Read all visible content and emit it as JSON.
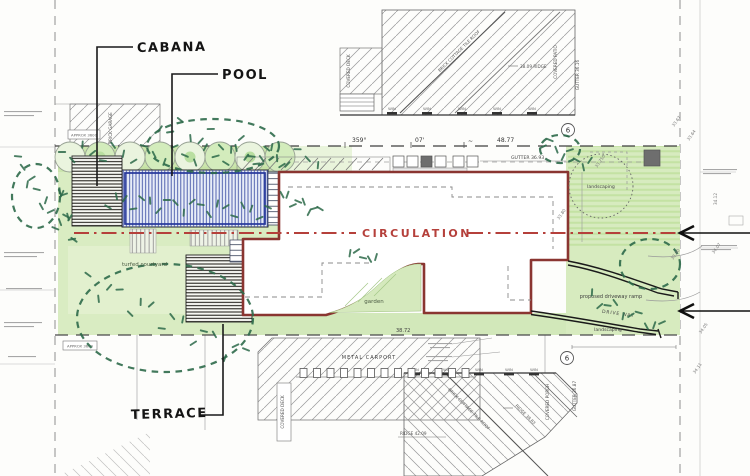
{
  "labels": {
    "cabana": "CABANA",
    "pool": "POOL",
    "terrace": "TERRACE",
    "circulation": "CIRCULATION"
  },
  "site_annotations": {
    "turfed_courtyard": "turfed courtyard",
    "garden": "garden",
    "landscaping_circle": "landscaping",
    "landscaping_strip": "landscaping",
    "proposed_driveway_ramp": "proposed driveway ramp",
    "driveway": "DRIVE WAY",
    "metal_carport": "METAL  CARPORT",
    "approx_dim_top": "APPROX  3600",
    "approx_dim_bottom": "APPROX  3600"
  },
  "boundary_dims": {
    "bearing_deg": "359°",
    "bearing_min": "07'",
    "tilde": "~",
    "frontage": "48.77",
    "rear": "38.72",
    "gutter": "GUTTER 36.93"
  },
  "neighbour_north": {
    "brick_garage": "BRICK GARAGE",
    "covered_deck": "COVERED DECK",
    "cottage": "BRICK COTTAGE TILE ROOF",
    "ridge": "38.09 RIDGE",
    "covered_patio": "COVERED PATIO",
    "gutter": "GUTTER 36.16",
    "window": "WIN"
  },
  "neighbour_south": {
    "cottage": "BRICK COTTAGE TILE ROOF",
    "ridge_a": "RIDGE 38.83",
    "ridge_b": "RIDGE 42.09",
    "covered_porch": "COVERED PORCH",
    "covered_deck": "COVERED DECK",
    "gutter": "GUTTER 36.87",
    "window": "WIN"
  },
  "markers": {
    "sheet_ref": "6"
  },
  "spot_levels": [
    "33.67",
    "33.64",
    "33.750",
    "33.80",
    "33.90",
    "34.05",
    "34.12",
    "34.11",
    "34.07"
  ],
  "colors": {
    "building_outline": "#8a3531",
    "circulation_red": "#b5403b",
    "landscape_green": "#d9ecc2",
    "pool_blue": "#4053a6",
    "tree_green": "#2d6a4a"
  }
}
